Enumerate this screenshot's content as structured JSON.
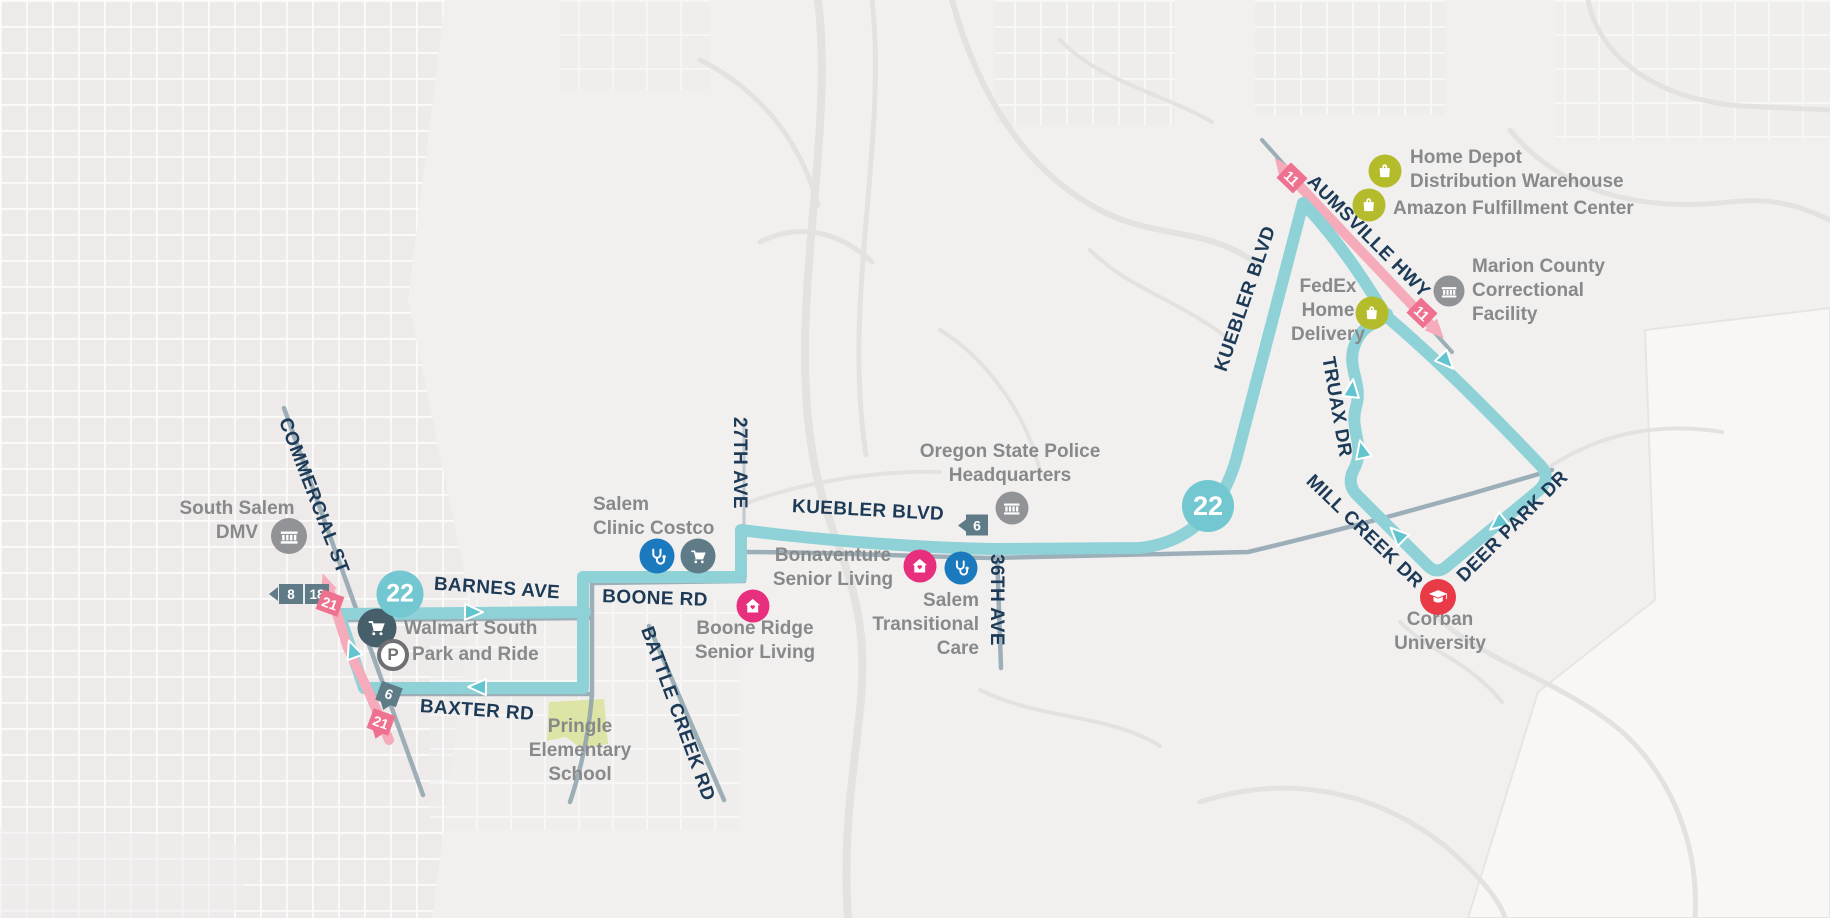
{
  "route": {
    "number": "22"
  },
  "colors": {
    "route_teal": "#8ed2d7",
    "route_teal_badge": "#72c7d1",
    "route_pink": "#f5abba",
    "badge_pink": "#ef7190",
    "badge_slate": "#5e7b87",
    "street_label": "#1d3a57",
    "landmark_label": "#87898b",
    "icon_olive": "#b5bc2c",
    "icon_gov_gray": "#919396",
    "icon_medical_blue": "#1b79bd",
    "icon_costco_slate": "#5e7b87",
    "icon_walmart_slate": "#465f6a",
    "icon_house_pink": "#e72f7d",
    "icon_corban_red": "#e93a47",
    "school_patch": "#dce3a1"
  },
  "streets": [
    {
      "label": "COMMERCIAL ST"
    },
    {
      "label": "BARNES AVE"
    },
    {
      "label": "BOONE RD"
    },
    {
      "label": "BAXTER RD"
    },
    {
      "label": "BATTLE CREEK RD"
    },
    {
      "label": "27TH AVE"
    },
    {
      "label": "KUEBLER BLVD"
    },
    {
      "label": "36TH AVE"
    },
    {
      "label": "KUEBLER BLVD"
    },
    {
      "label": "AUMSVILLE HWY"
    },
    {
      "label": "TRUAX DR"
    },
    {
      "label": "MILL CREEK DR"
    },
    {
      "label": "DEER PARK DR"
    }
  ],
  "landmarks": [
    {
      "id": "south-salem-dmv",
      "lines": [
        "South Salem",
        "DMV"
      ]
    },
    {
      "id": "walmart-south-park-and-ride",
      "lines": [
        "Walmart South",
        "Park and Ride"
      ]
    },
    {
      "id": "pringle-elementary-school",
      "lines": [
        "Pringle",
        "Elementary",
        "School"
      ]
    },
    {
      "id": "salem-clinic-costco",
      "lines": [
        "Salem",
        "Clinic Costco"
      ]
    },
    {
      "id": "boone-ridge-senior-living",
      "lines": [
        "Boone Ridge",
        "Senior Living"
      ]
    },
    {
      "id": "bonaventure-senior-living",
      "lines": [
        "Bonaventure",
        "Senior Living"
      ]
    },
    {
      "id": "salem-transitional-care",
      "lines": [
        "Salem",
        "Transitional",
        "Care"
      ]
    },
    {
      "id": "oregon-state-police-headquarters",
      "lines": [
        "Oregon State Police",
        "Headquarters"
      ]
    },
    {
      "id": "fedex-home-delivery",
      "lines": [
        "FedEx",
        "Home",
        "Delivery"
      ]
    },
    {
      "id": "home-depot-distribution-warehouse",
      "lines": [
        "Home Depot",
        "Distribution Warehouse"
      ]
    },
    {
      "id": "amazon-fulfillment-center",
      "lines": [
        "Amazon Fulfillment Center"
      ]
    },
    {
      "id": "marion-county-correctional-facility",
      "lines": [
        "Marion County",
        "Correctional",
        "Facility"
      ]
    },
    {
      "id": "corban-university",
      "lines": [
        "Corban",
        "University"
      ]
    }
  ],
  "badges": {
    "route22_west": "22",
    "route22_east": "22",
    "route8": "8",
    "route18": "18",
    "route21_north": "21",
    "route21_south": "21",
    "route6_baxter": "6",
    "route6_kuebler": "6",
    "route11_north": "11",
    "route11_south": "11"
  },
  "icons": {
    "parking_letter": "P"
  }
}
